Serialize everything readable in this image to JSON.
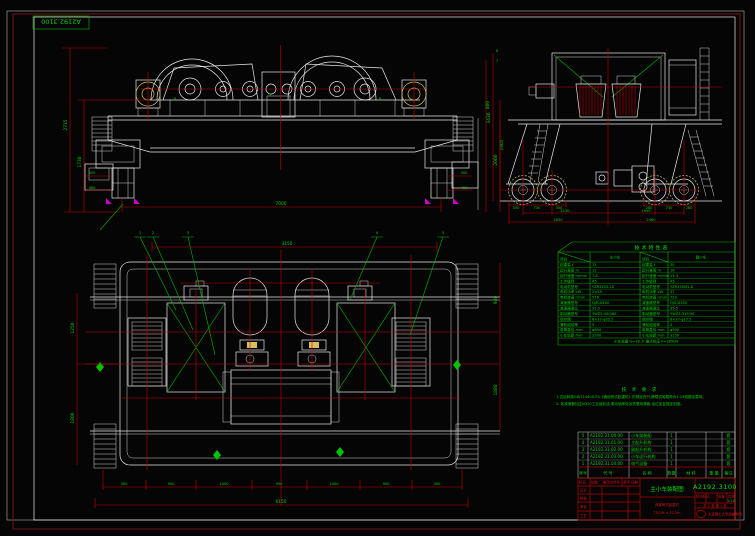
{
  "sheet": {
    "mirrored_doc_no": "A2192.3100"
  },
  "front_view": {
    "dims": {
      "span": "7000",
      "left_outer": "2715",
      "left_inner": "1730",
      "right_v1": "800",
      "right_v2": "1905",
      "lw1": "300",
      "lw2": "460",
      "rw1": "300",
      "rw2": "460"
    },
    "marks": [
      "B",
      "D",
      "B"
    ]
  },
  "side_view": {
    "dims": {
      "bl1": "350",
      "bl2": "730",
      "bl3": "350",
      "br1": "280",
      "br2": "730",
      "br3": "280",
      "mid_left": "2130",
      "mid_right": "1900",
      "tot_left": "2830",
      "tot_right": "2460",
      "left_v": "2000",
      "left_v2": "3430"
    },
    "marks": [
      "6",
      "7"
    ]
  },
  "plan_view": {
    "callouts": [
      "1",
      "2",
      "3",
      "4",
      "5"
    ],
    "dims": {
      "top": "3150",
      "bottom": [
        "300",
        "900",
        "1400",
        "950",
        "1400",
        "900",
        "300"
      ],
      "total": "6150",
      "left_v1": "1250",
      "left_v2": "1800",
      "right_v1": "940",
      "right_v2": "1880"
    }
  },
  "spec_table": {
    "title": "技术特性表",
    "header": {
      "diag1": "项目",
      "col2": "主小车",
      "diag2": "项目",
      "col4": "副小车"
    },
    "rows": [
      [
        "起重量 t",
        "75",
        "起重量 t",
        "20"
      ],
      [
        "起升高度 m",
        "12",
        "起升高度 m",
        "16"
      ],
      [
        "起升速度 m/min",
        "7.8",
        "起升速度 m/min",
        "13.3"
      ],
      [
        "工作级别",
        "A5",
        "工作级别",
        "A5"
      ],
      [
        "电动机型号",
        "YZR315S-10",
        "电动机型号",
        "YZR250M1-8"
      ],
      [
        "电机功率 kW",
        "2×55",
        "电机功率 kW",
        "37"
      ],
      [
        "电机转速 r/min",
        "578",
        "电机转速 r/min",
        "723"
      ],
      [
        "减速器型号",
        "QJR-D400",
        "减速器型号",
        "QJS-D335"
      ],
      [
        "减速器速比",
        "31.5",
        "减速器速比",
        "35.5"
      ],
      [
        "制动器型号",
        "YWZ5-400/80",
        "制动器型号",
        "YWZ5-315/50"
      ],
      [
        "钢丝绳",
        "6×37-φ32.5",
        "钢丝绳",
        "6×37-φ17.5"
      ],
      [
        "滑轮组倍率",
        "5",
        "滑轮组倍率",
        "4"
      ],
      [
        "卷筒直径 mm",
        "φ800",
        "卷筒直径 mm",
        "φ500"
      ],
      [
        "小车轨距 mm",
        "2500",
        "小车轮距 mm",
        "3150"
      ]
    ],
    "footer": "小车总重 G=28.7t    最大轮压 P=285kN"
  },
  "notes": {
    "title": "技 术 要 求",
    "lines": [
      "1.试运转按GB/T14405-93《通用桥式起重机》的规定进行,静载试验载荷为1.25倍额定载荷。",
      "2. 各减速器加注N320工业齿轮油,滚动轴承处涂钙基润滑脂,油位加至规定刻度。"
    ]
  },
  "bom": {
    "headers": [
      "序号",
      "代 号",
      "名 称",
      "数量",
      "材 料",
      "重 量",
      "备注"
    ],
    "rows": [
      {
        "no": "5",
        "code": "A2192.31.00.00",
        "name": "小车架装配",
        "qty": "1",
        "note": "套"
      },
      {
        "no": "4",
        "code": "A2192.31.01.00",
        "name": "主起升机构",
        "qty": "1",
        "note": "套"
      },
      {
        "no": "3",
        "code": "A2192.31.02.00",
        "name": "副起升机构",
        "qty": "1",
        "note": "套"
      },
      {
        "no": "2",
        "code": "A2192.31.03.00",
        "name": "小车运行机构",
        "qty": "1",
        "note": "套"
      },
      {
        "no": "1",
        "code": "A2192.31.04.00",
        "name": "电气设备",
        "qty": "1",
        "note": "套"
      }
    ]
  },
  "title_block": {
    "drawing_no": "A2192.3100",
    "title": "主小车装配图",
    "product_line1": "双梁桥式起重机",
    "product_line2": "75/20t × 22.5m",
    "company": "大连理工大学机械学院",
    "rev_headers": [
      "标记",
      "处数",
      "更改文件号",
      "签字",
      "日期"
    ],
    "sign_rows": [
      "设计",
      "校核",
      "审定",
      "工艺"
    ],
    "stage_label": "阶段标记",
    "weight_label": "质量",
    "scale_label": "比例",
    "scale_value": "1:10",
    "sheet_info": "共 1 张  第 1 张"
  },
  "colors": {
    "line_white": "#e8e8e8",
    "dim_red": "#c40000",
    "anno_green": "#00d000",
    "frame_maroon": "#6e1212",
    "accent_yellow": "#d8c060",
    "accent_magenta": "#cc00cc"
  }
}
